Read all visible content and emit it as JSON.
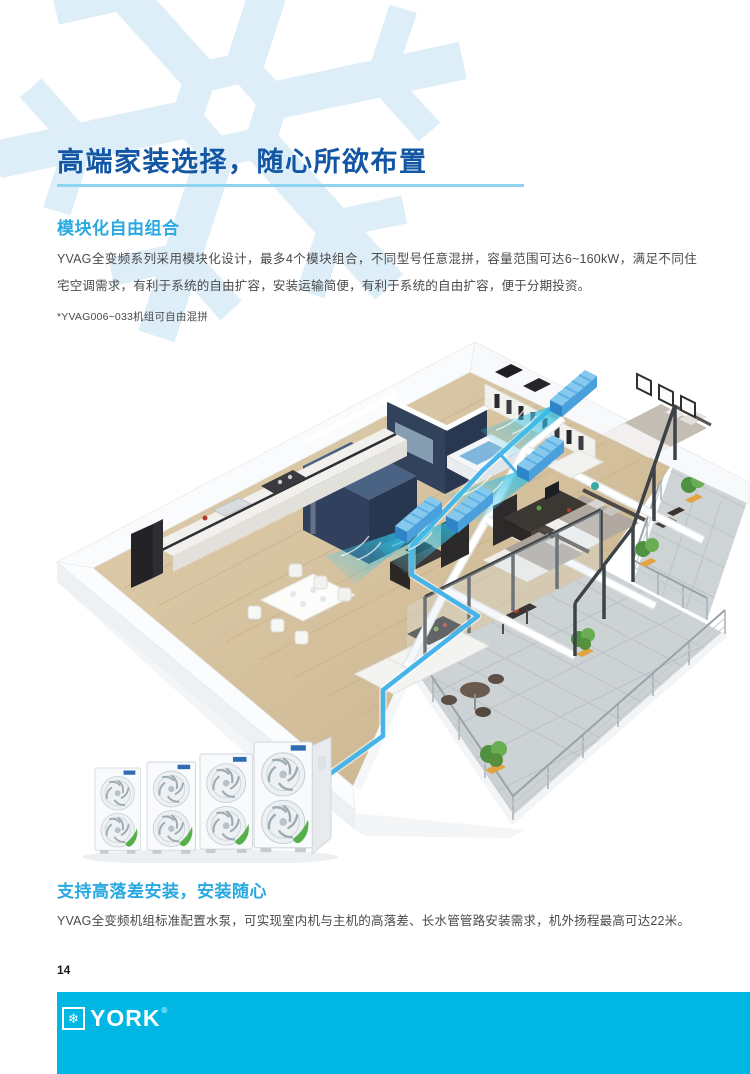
{
  "page": {
    "number": "14",
    "background": "#ffffff"
  },
  "header": {
    "title": "高端家装选择，随心所欲布置"
  },
  "sections": [
    {
      "heading": "模块化自由组合",
      "body": "YVAG全变频系列采用模块化设计，最多4个模块组合，不同型号任意混拼，容量范围可达6~160kW，满足不同住宅空调需求，有利于系统的自由扩容，安装运输简便，有利于系统的自由扩容，便于分期投资。",
      "footnote": "*YVAG006~033机组可自由混拼"
    },
    {
      "heading": "支持高落差安装，安装随心",
      "body": "YVAG全变频机组标准配置水泵，可实现室内机与主机的高落差、长水管管路安装需求，机外扬程最高可达22米。"
    }
  ],
  "illustration": {
    "alt": "三维户型图：四台室内风管机经蓝色水管连接至楼下四模块室外机组",
    "indoor_unit_count": 4,
    "outdoor_module_count": 4
  },
  "footer": {
    "brand": "YORK",
    "registered_mark": "®"
  },
  "colors": {
    "title_blue": "#1356a3",
    "accent_cyan": "#29a9e0",
    "underline_cyan": "#8ed4f1",
    "footer_bar": "#00b6e2",
    "body_text": "#4a4a4a",
    "watermark_blue": "#ddeef9",
    "pipe_blue": "#46b4e8"
  }
}
